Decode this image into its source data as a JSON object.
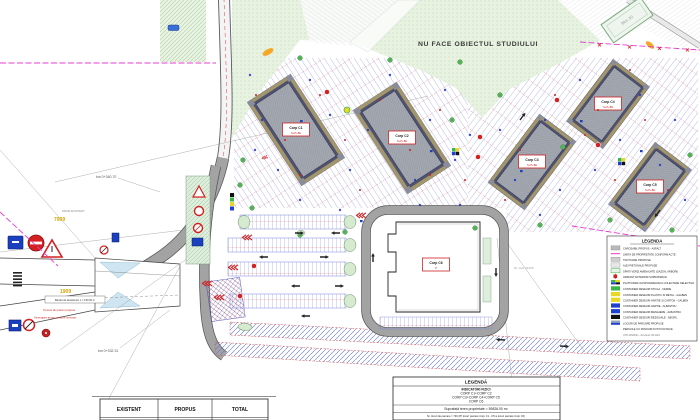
{
  "labels": {
    "no_study": "NU FACE OBIECTUL STUDIULUI",
    "km_top": "km 0+340.70",
    "km_bottom": "km 0+332.31",
    "ref_top": "7909",
    "ref_bottom": "1909",
    "existing_road": "DRUM EXISTENT",
    "existing_block": "Bloc 30",
    "cad_note": "Nr. cad. 31245",
    "note_decel": "Banda de decelerare L = 150.00 m",
    "note_crossing": "Trecere de pietoni propusa",
    "note_access": "Amenajare acces conform normativ"
  },
  "buildings": [
    {
      "label": "Corp C1",
      "sub": "S+P+8E"
    },
    {
      "label": "Corp C2",
      "sub": "S+P+8E"
    },
    {
      "label": "Corp C3",
      "sub": "S+P+8E"
    },
    {
      "label": "Corp C4",
      "sub": "S+P+8E"
    },
    {
      "label": "Corp C5",
      "sub": "S+P+8E"
    },
    {
      "label": "Corp C6",
      "sub": "P"
    }
  ],
  "legend_box": {
    "title": "LEGENDA",
    "items": [
      {
        "color": "#b9b9b9",
        "label": "CAROSABIL PROPUS - ASFALT"
      },
      {
        "color": "#f05ad0",
        "label": "LIMITA DE PROPRIETATE CONFORM ACTE"
      },
      {
        "color": "#cfcfcf",
        "label": "TROTUARE PROPUSE"
      },
      {
        "color": "#e8e8e8",
        "label": "ALEI PIETONALE PROPUSE"
      },
      {
        "color": "#eaf4e6",
        "label": "SPATII VERZI AMENAJATE (GAZON, ARBORI)"
      },
      {
        "color": "#d42020",
        "label": "HIDRANT EXTERIOR SUPRATERAN"
      },
      {
        "color": "multi",
        "label": "PLATFORMA GOSPODAREASCA COLECTARE SELECTIVA"
      },
      {
        "color": "#3cb44a",
        "label": "CONTAINER DESEURI STICLA - VERDE"
      },
      {
        "color": "#e8d825",
        "label": "CONTAINER DESEURI PLASTIC SI METAL - GALBEN"
      },
      {
        "color": "#e8d825",
        "label": "CONTAINER DESEURI HARTIE SI CARTON - GALBEN"
      },
      {
        "color": "#2040d0",
        "label": "CONTAINER DESEURI HARTIE - ALBASTRU"
      },
      {
        "color": "#2040d0",
        "label": "CONTAINER DESEURI MENAJERE - ALBASTRU"
      },
      {
        "color": "#111111",
        "label": "CONTAINER DESEURI REZIDUALE - NEGRU"
      },
      {
        "color": "#9aa4b8",
        "label": "LOCURI DE PARCARE PROPUSE"
      },
      {
        "color": "none",
        "label": "PERGOLE CU PANOURI FOTOVOLTAICE"
      }
    ],
    "footnote": "UTR 035/2021 - Revizuire 05.2021"
  },
  "indicators_box": {
    "title": "LEGENDĂ",
    "subtitle": "INDICATORI FIZICI",
    "corp_line1": "CORP C1+CORP C2",
    "corp_line2": "CORP C3+CORP C4+CORP C5",
    "corp_line3": "CORP C6",
    "area_line": "Suprafață teren proprietate = 59826.00 m²",
    "parking_line": "Nr. locuri de parcare = 746 (87 locuri parcare Corp C1 - C5 si locuri parcare Corp C6)"
  },
  "summary_table": {
    "headers": [
      "EXISTENT",
      "PROPUS",
      "TOTAL"
    ]
  },
  "colors": {
    "boundary": "#e83bd0",
    "road_fill": "#a8a8a8",
    "green_area": "#e7f2e0",
    "stall_blue": "#7b86d8",
    "stall_red": "#d65050",
    "sign_red": "#d42020",
    "sign_blue": "#1a3fbf",
    "building_gray": "#a2a7b0",
    "building_band": "#a3966b"
  }
}
